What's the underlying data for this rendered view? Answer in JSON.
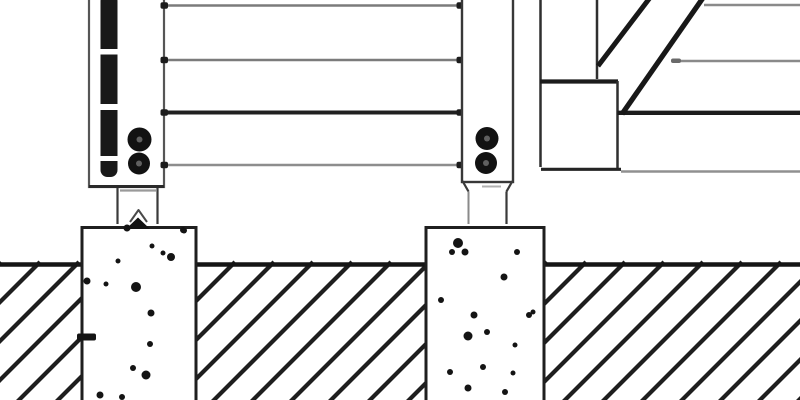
{
  "meta": {
    "title": "Construction detail drawing: fence/deck posts with bolted anchor straps on concrete pier footings, horizontal rails, stair stringer at right, soil section with diagonal hatching",
    "canvas": {
      "width": 800,
      "height": 400
    },
    "palette": {
      "background": "#ffffff",
      "line_dark": "#1c1c1c",
      "line_medium": "#3a3a3a",
      "line_gray": "#828282",
      "line_light_gray": "#9a9a9a",
      "ink_black": "#141414"
    }
  },
  "scene": {
    "shapes": [
      {
        "name": "soil-hatch-line",
        "type": "hatch",
        "x_start": -180,
        "x_end": 830,
        "step": 39,
        "y_bottom": 404,
        "y_top": 262,
        "dx": 142,
        "stroke": "#1e1e1e",
        "width": 4.2
      },
      {
        "name": "ground-line",
        "type": "line",
        "x1": -2,
        "y1": 264.5,
        "x2": 802,
        "y2": 264.5,
        "stroke": "#151515",
        "width": 4.6
      },
      {
        "name": "left-footing-fill",
        "type": "rect",
        "x": 82,
        "y": 226,
        "w": 114,
        "h": 178,
        "fill": "#ffffff"
      },
      {
        "name": "left-footing-border",
        "type": "path",
        "d": "M 82 404 L 82 227.5 L 196 227.5 L 196 404",
        "stroke": "#1f1f1f",
        "width": 3,
        "fill": "none"
      },
      {
        "name": "right-footing-fill",
        "type": "rect",
        "x": 426,
        "y": 226,
        "w": 118,
        "h": 178,
        "fill": "#ffffff"
      },
      {
        "name": "right-footing-border",
        "type": "path",
        "d": "M 426 404 L 426 227.5 L 544 227.5 L 544 404",
        "stroke": "#1f1f1f",
        "width": 3,
        "fill": "none"
      },
      {
        "name": "left-footing-notch",
        "type": "rect",
        "x": 77,
        "y": 333.5,
        "w": 19,
        "h": 7,
        "rx": 2,
        "fill": "#141414"
      },
      {
        "name": "footing-speckle",
        "type": "dots",
        "fill": "#141414",
        "points": [
          [
            127,
            228,
            3.5
          ],
          [
            183,
            230,
            3
          ],
          [
            152,
            246,
            2.5
          ],
          [
            171,
            257,
            4
          ],
          [
            87,
            281,
            3.5
          ],
          [
            106,
            284,
            2.5
          ],
          [
            136,
            287,
            5
          ],
          [
            151,
            313,
            3.5
          ],
          [
            150,
            344,
            3
          ],
          [
            133,
            368,
            3
          ],
          [
            146,
            375,
            4.5
          ],
          [
            100,
            395,
            3.5
          ],
          [
            122,
            397,
            3
          ],
          [
            163,
            253,
            2.5
          ],
          [
            118,
            261,
            2.5
          ],
          [
            184,
            230.5,
            3
          ]
        ]
      },
      {
        "name": "footing-speckle",
        "type": "dots",
        "fill": "#141414",
        "points": [
          [
            458,
            243,
            5
          ],
          [
            465,
            252,
            3.5
          ],
          [
            452,
            252,
            3
          ],
          [
            517,
            252,
            3
          ],
          [
            504,
            277,
            3.5
          ],
          [
            441,
            300,
            3
          ],
          [
            474,
            315,
            3.5
          ],
          [
            529,
            315,
            3
          ],
          [
            468,
            336,
            4.5
          ],
          [
            487,
            332,
            3
          ],
          [
            515,
            345,
            2.5
          ],
          [
            483,
            367,
            3
          ],
          [
            513,
            373,
            2.5
          ],
          [
            468,
            388,
            3.5
          ],
          [
            533,
            312,
            2.5
          ],
          [
            450,
            372,
            3
          ],
          [
            505,
            392,
            3
          ]
        ]
      },
      {
        "name": "left-post-body",
        "type": "rect",
        "x": 89,
        "y": -6,
        "w": 75,
        "h": 193,
        "fill": "#ffffff",
        "stroke": "#565656",
        "width": 2.2
      },
      {
        "name": "left-post-bottom-edge",
        "type": "line",
        "x1": 89,
        "y1": 186.5,
        "x2": 164,
        "y2": 186.5,
        "stroke": "#2a2a2a",
        "width": 3
      },
      {
        "name": "left-post-anchor-bar",
        "type": "rect",
        "x": 100.5,
        "y": -6,
        "w": 17,
        "h": 183,
        "rx": 7,
        "fill": "#191919"
      },
      {
        "name": "anchor-bar-gap",
        "type": "rect",
        "x": 98.5,
        "y": 49,
        "w": 21,
        "h": 5.5,
        "fill": "#ffffff"
      },
      {
        "name": "anchor-bar-gap",
        "type": "rect",
        "x": 98.5,
        "y": 104,
        "w": 21,
        "h": 6,
        "fill": "#ffffff"
      },
      {
        "name": "anchor-bar-gap",
        "type": "rect",
        "x": 98.5,
        "y": 156,
        "w": 21,
        "h": 5,
        "fill": "#ffffff"
      },
      {
        "name": "left-post-bottom-lip",
        "type": "line",
        "x1": 120,
        "y1": 190.5,
        "x2": 156,
        "y2": 190.5,
        "stroke": "#9a9a9a",
        "width": 2.2
      },
      {
        "name": "left-strap-left-line",
        "type": "line",
        "x1": 117.5,
        "y1": 188,
        "x2": 117.5,
        "y2": 224,
        "stroke": "#3a3a3a",
        "width": 2.2
      },
      {
        "name": "left-strap-right-line",
        "type": "line",
        "x1": 157.5,
        "y1": 188,
        "x2": 157.5,
        "y2": 224,
        "stroke": "#3a3a3a",
        "width": 2.2
      },
      {
        "name": "left-anchor-caret",
        "type": "polyline",
        "points": "130,222 138.5,210 147,222",
        "stroke": "#4a4a4a",
        "width": 2,
        "fill": "none"
      },
      {
        "name": "left-anchor-arrow",
        "type": "polygon",
        "points": "126,229 138,217.5 150,229",
        "fill": "#121212"
      },
      {
        "name": "left-post-bolt",
        "type": "circle",
        "cx": 139.5,
        "cy": 139.5,
        "r": 12,
        "fill": "#121212"
      },
      {
        "name": "left-post-bolt-center",
        "type": "circle",
        "cx": 139.5,
        "cy": 139.5,
        "r": 3,
        "fill": "#606060"
      },
      {
        "name": "left-post-bolt",
        "type": "circle",
        "cx": 139,
        "cy": 163.5,
        "r": 11,
        "fill": "#121212"
      },
      {
        "name": "left-post-bolt-center",
        "type": "circle",
        "cx": 139,
        "cy": 163.5,
        "r": 3,
        "fill": "#606060"
      },
      {
        "name": "rail-top",
        "type": "line",
        "x1": 167,
        "y1": 5.5,
        "x2": 461,
        "y2": 5.5,
        "stroke": "#7b7b7b",
        "width": 2.6
      },
      {
        "name": "rail-second",
        "type": "line",
        "x1": 167,
        "y1": 60,
        "x2": 461,
        "y2": 60,
        "stroke": "#7b7b7b",
        "width": 2.6
      },
      {
        "name": "rail-third-dark",
        "type": "line",
        "x1": 165,
        "y1": 112.5,
        "x2": 461,
        "y2": 112.5,
        "stroke": "#202020",
        "width": 4
      },
      {
        "name": "rail-bottom",
        "type": "line",
        "x1": 167,
        "y1": 165,
        "x2": 461,
        "y2": 165,
        "stroke": "#8d8d8d",
        "width": 2.6
      },
      {
        "name": "rail-end-tick",
        "type": "rect",
        "x": 160.5,
        "y": 2.2,
        "w": 7.5,
        "h": 6.5,
        "rx": 2,
        "fill": "#1c1c1c"
      },
      {
        "name": "rail-end-tick",
        "type": "rect",
        "x": 160.5,
        "y": 56.7,
        "w": 7.5,
        "h": 6.5,
        "rx": 2,
        "fill": "#1c1c1c"
      },
      {
        "name": "rail-end-tick",
        "type": "rect",
        "x": 160.5,
        "y": 109.2,
        "w": 7.5,
        "h": 6.5,
        "rx": 2,
        "fill": "#1c1c1c"
      },
      {
        "name": "rail-end-tick",
        "type": "rect",
        "x": 160.5,
        "y": 161.7,
        "w": 7.5,
        "h": 6.5,
        "rx": 2,
        "fill": "#1c1c1c"
      },
      {
        "name": "rail-end-tick",
        "type": "rect",
        "x": 456.5,
        "y": 2.2,
        "w": 7.5,
        "h": 6.5,
        "rx": 2,
        "fill": "#1c1c1c"
      },
      {
        "name": "rail-end-tick",
        "type": "rect",
        "x": 456.5,
        "y": 56.7,
        "w": 7.5,
        "h": 6.5,
        "rx": 2,
        "fill": "#1c1c1c"
      },
      {
        "name": "rail-end-tick",
        "type": "rect",
        "x": 456.5,
        "y": 109.2,
        "w": 7.5,
        "h": 6.5,
        "rx": 2,
        "fill": "#1c1c1c"
      },
      {
        "name": "rail-end-tick",
        "type": "rect",
        "x": 456.5,
        "y": 161.7,
        "w": 7.5,
        "h": 6.5,
        "rx": 2,
        "fill": "#1c1c1c"
      },
      {
        "name": "right-post-body",
        "type": "rect",
        "x": 462,
        "y": -6,
        "w": 51,
        "h": 188,
        "fill": "#ffffff",
        "stroke": "#383838",
        "width": 2.4
      },
      {
        "name": "right-post-chamfer-left",
        "type": "line",
        "x1": 462.5,
        "y1": 181,
        "x2": 468.5,
        "y2": 191.5,
        "stroke": "#3a3a3a",
        "width": 2.2
      },
      {
        "name": "right-post-chamfer-right",
        "type": "line",
        "x1": 512.5,
        "y1": 181,
        "x2": 506.5,
        "y2": 191.5,
        "stroke": "#3a3a3a",
        "width": 2.2
      },
      {
        "name": "right-post-bottom-lip",
        "type": "line",
        "x1": 482,
        "y1": 186.5,
        "x2": 501,
        "y2": 186.5,
        "stroke": "#b0b0b0",
        "width": 2
      },
      {
        "name": "right-strap-left-line",
        "type": "line",
        "x1": 468.5,
        "y1": 191.5,
        "x2": 468.5,
        "y2": 224,
        "stroke": "#8a8a8a",
        "width": 2
      },
      {
        "name": "right-strap-right-line",
        "type": "line",
        "x1": 506.5,
        "y1": 191.5,
        "x2": 506.5,
        "y2": 224,
        "stroke": "#3a3a3a",
        "width": 2.2
      },
      {
        "name": "right-post-bolt",
        "type": "circle",
        "cx": 487,
        "cy": 138.5,
        "r": 11.5,
        "fill": "#121212"
      },
      {
        "name": "right-post-bolt-center",
        "type": "circle",
        "cx": 487,
        "cy": 138.5,
        "r": 3,
        "fill": "#606060"
      },
      {
        "name": "right-post-bolt",
        "type": "circle",
        "cx": 486,
        "cy": 163,
        "r": 11,
        "fill": "#121212"
      },
      {
        "name": "right-post-bolt-center",
        "type": "circle",
        "cx": 486,
        "cy": 163,
        "r": 3,
        "fill": "#606060"
      },
      {
        "name": "stair-riser-left-edge",
        "type": "line",
        "x1": 540.5,
        "y1": -6,
        "x2": 540.5,
        "y2": 167,
        "stroke": "#2f2f2f",
        "width": 2.5
      },
      {
        "name": "stair-riser-right-edge",
        "type": "line",
        "x1": 597,
        "y1": -6,
        "x2": 597,
        "y2": 79,
        "stroke": "#2f2f2f",
        "width": 2.5
      },
      {
        "name": "stair-tread-top-edge",
        "type": "line",
        "x1": 540,
        "y1": 81.5,
        "x2": 618,
        "y2": 81.5,
        "stroke": "#1c1c1c",
        "width": 4.2
      },
      {
        "name": "stair-tread-right-edge",
        "type": "line",
        "x1": 617.5,
        "y1": 81,
        "x2": 617.5,
        "y2": 170,
        "stroke": "#2f2f2f",
        "width": 2.5
      },
      {
        "name": "stair-rail-dark",
        "type": "line",
        "x1": 617.5,
        "y1": 112.8,
        "x2": 802,
        "y2": 112.8,
        "stroke": "#1c1c1c",
        "width": 4.4
      },
      {
        "name": "stair-bottom-edge",
        "type": "line",
        "x1": 541,
        "y1": 169.3,
        "x2": 621,
        "y2": 169.3,
        "stroke": "#242424",
        "width": 3.2
      },
      {
        "name": "stair-bottom-rail-gray",
        "type": "line",
        "x1": 621,
        "y1": 171.5,
        "x2": 802,
        "y2": 171.5,
        "stroke": "#909090",
        "width": 2.4
      },
      {
        "name": "stair-top-rail-gray",
        "type": "line",
        "x1": 704,
        "y1": 5,
        "x2": 802,
        "y2": 5,
        "stroke": "#8a8a8a",
        "width": 2.4
      },
      {
        "name": "stair-mid-rail-gray",
        "type": "line",
        "x1": 672,
        "y1": 61,
        "x2": 802,
        "y2": 61,
        "stroke": "#8a8a8a",
        "width": 2.4
      },
      {
        "name": "stair-mid-rail-tick",
        "type": "rect",
        "x": 671,
        "y": 58.5,
        "w": 10,
        "h": 4.5,
        "rx": 2,
        "fill": "#6a6a6a"
      },
      {
        "name": "stringer-diagonal-upper",
        "type": "line",
        "x1": 598,
        "y1": 66,
        "x2": 652,
        "y2": -5,
        "stroke": "#181818",
        "width": 5
      },
      {
        "name": "stringer-diagonal-lower",
        "type": "line",
        "x1": 622,
        "y1": 114,
        "x2": 705,
        "y2": -5,
        "stroke": "#181818",
        "width": 5.2
      }
    ]
  }
}
